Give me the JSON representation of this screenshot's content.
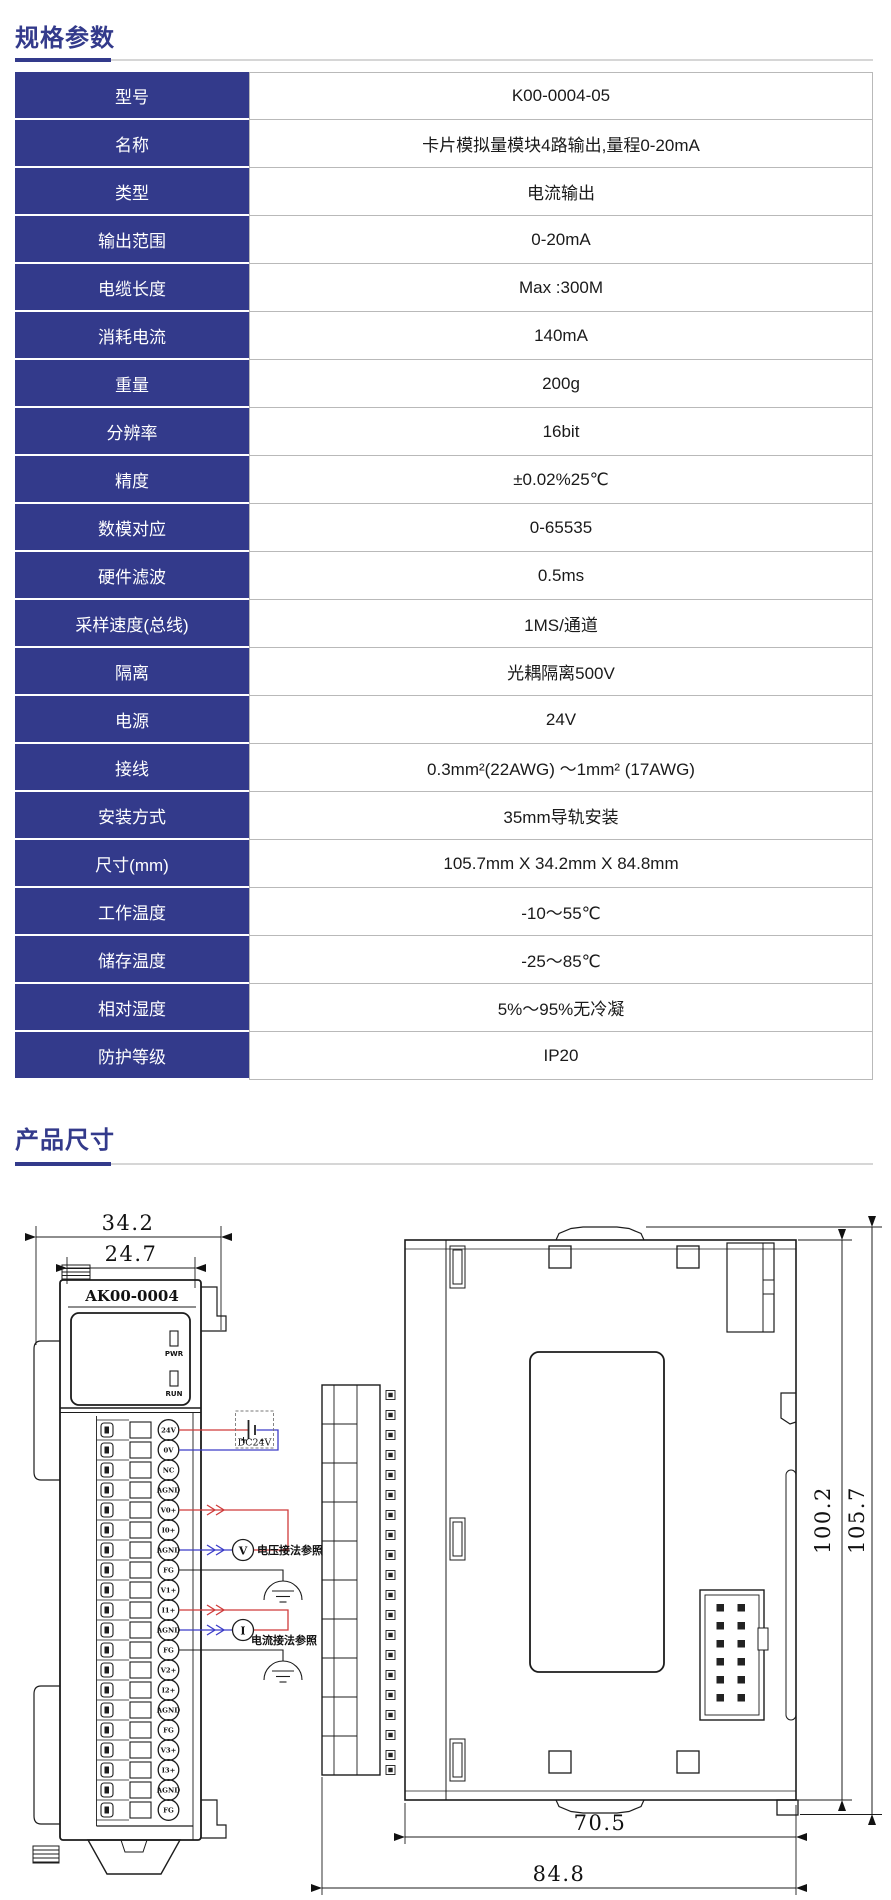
{
  "meta": {
    "accent_color": "#333a8b",
    "rule_color": "#d6d6d6",
    "table_border_color": "#b9b9b9",
    "wire_red": "#cf3b3b",
    "wire_blue": "#3c3cc8"
  },
  "sections": {
    "specs_title": "规格参数",
    "dims_title": "产品尺寸"
  },
  "spec_table": {
    "rows": [
      {
        "label": "型号",
        "value": "K00-0004-05"
      },
      {
        "label": "名称",
        "value": "卡片模拟量模块4路输出,量程0-20mA"
      },
      {
        "label": "类型",
        "value": "电流输出"
      },
      {
        "label": "输出范围",
        "value": "0-20mA"
      },
      {
        "label": "电缆长度",
        "value": "Max :300M"
      },
      {
        "label": "消耗电流",
        "value": "140mA"
      },
      {
        "label": "重量",
        "value": "200g"
      },
      {
        "label": "分辨率",
        "value": "16bit"
      },
      {
        "label": "精度",
        "value": "±0.02%25℃"
      },
      {
        "label": "数模对应",
        "value": "0-65535"
      },
      {
        "label": "硬件滤波",
        "value": "0.5ms"
      },
      {
        "label": "采样速度(总线)",
        "value": "1MS/通道"
      },
      {
        "label": "隔离",
        "value": "光耦隔离500V"
      },
      {
        "label": "电源",
        "value": "24V"
      },
      {
        "label": "接线",
        "value": "0.3mm²(22AWG) ～1mm² (17AWG)"
      },
      {
        "label": "安装方式",
        "value": "35mm导轨安装"
      },
      {
        "label": "尺寸(mm)",
        "value": "105.7mm X 34.2mm X 84.8mm"
      },
      {
        "label": "工作温度",
        "value": "-10～55℃"
      },
      {
        "label": "储存温度",
        "value": "-25～85℃"
      },
      {
        "label": "相对湿度",
        "value": "5%～95%无冷凝"
      },
      {
        "label": "防护等级",
        "value": "IP20"
      }
    ]
  },
  "drawing": {
    "front_view": {
      "model_label": "AK00-0004",
      "pwr_label": "PWR",
      "run_label": "RUN",
      "dim_outer_width": "34.2",
      "dim_inner_width": "24.7",
      "terminals": [
        "24V",
        "0V",
        "NC",
        "AGND",
        "V0+",
        "I0+",
        "AGND",
        "FG",
        "V1+",
        "I1+",
        "AGND",
        "FG",
        "V2+",
        "I2+",
        "AGND",
        "FG",
        "V3+",
        "I3+",
        "AGND",
        "FG"
      ],
      "power_box": {
        "label": "DC24V",
        "plus": "+",
        "minus": "-"
      },
      "voltage_meter": "V",
      "current_meter": "I",
      "voltage_note": "电压接法参照",
      "current_note": "电流接法参照"
    },
    "side_view": {
      "dim_inner_height": "100.2",
      "dim_outer_height": "105.7",
      "dim_inner_depth": "70.5",
      "dim_outer_depth": "84.8"
    }
  }
}
